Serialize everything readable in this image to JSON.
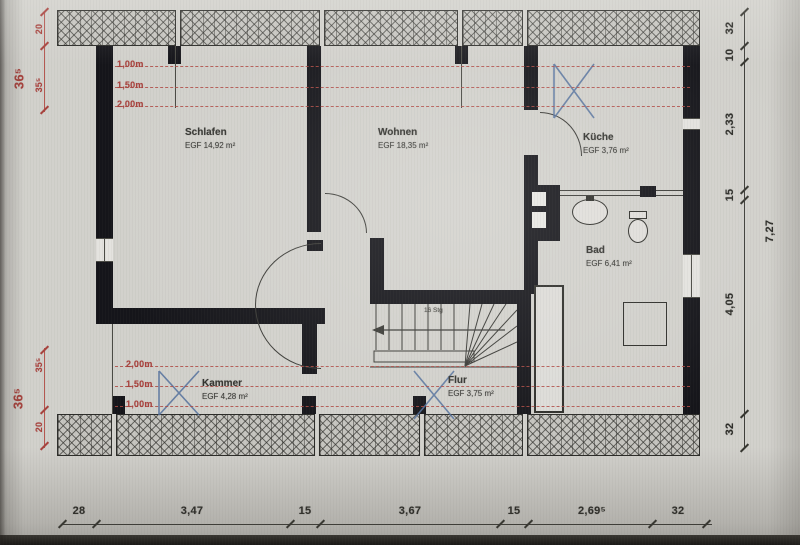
{
  "colors": {
    "paper": "#d2d1cc",
    "ink": "#2e2e2a",
    "wall_black": "#15151a",
    "dimension_red": "#a8433e",
    "roof_window_blue": "#54719e"
  },
  "rooms": [
    {
      "name": "Schlafen",
      "area": "EGF 14,92 m²"
    },
    {
      "name": "Wohnen",
      "area": "EGF 18,35 m²"
    },
    {
      "name": "Küche",
      "area": "EGF 3,76 m²"
    },
    {
      "name": "Bad",
      "area": "EGF 6,41 m²"
    },
    {
      "name": "Kammer",
      "area": "EGF 4,28 m²"
    },
    {
      "name": "Flur",
      "area": "EGF 3,75 m²"
    }
  ],
  "height_lines": {
    "top": [
      "1,00m",
      "1,50m",
      "2,00m"
    ],
    "bottom": [
      "2,00m",
      "1,50m",
      "1,00m"
    ]
  },
  "dimensions": {
    "bottom": [
      "28",
      "3,47",
      "15",
      "3,67",
      "15",
      "2,69⁵",
      "32"
    ],
    "right": [
      "32",
      "10",
      "2,33",
      "15",
      "4,05",
      "32"
    ],
    "right_overall": "7,27",
    "left_top": [
      "20",
      "35⁵"
    ],
    "left_top_big": "36⁵",
    "left_bottom": [
      "35⁵",
      "20"
    ],
    "left_bottom_big": "36⁵"
  },
  "stairs": {
    "label": "16 Stg"
  },
  "icons": [
    {
      "name": "roof-window-icon",
      "glyph": "✕"
    }
  ]
}
